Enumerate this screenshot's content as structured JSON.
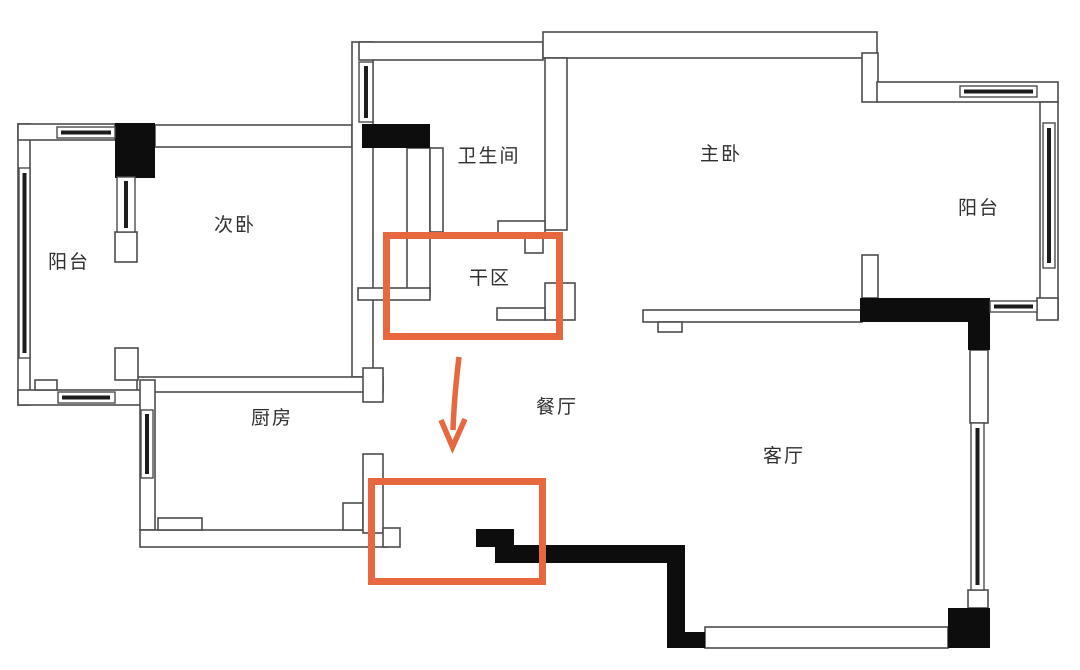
{
  "figure": {
    "type": "floor-plan",
    "description_visible_text_only": true
  },
  "palette": {
    "background": "#ffffff",
    "wall_line": "#4c4c4c",
    "solid_wall": "#0d0d0d",
    "window_core": "#1c1c1c",
    "highlight": "#e7683f",
    "label_color": "#2f2f2f"
  },
  "rooms": [
    {
      "id": "balcony-left",
      "label": "阳台"
    },
    {
      "id": "secondary-bedroom",
      "label": "次卧"
    },
    {
      "id": "bathroom",
      "label": "卫生间"
    },
    {
      "id": "master-bedroom",
      "label": "主卧"
    },
    {
      "id": "balcony-right",
      "label": "阳台"
    },
    {
      "id": "dry-area",
      "label": "干区"
    },
    {
      "id": "kitchen",
      "label": "厨房"
    },
    {
      "id": "dining-room",
      "label": "餐厅"
    },
    {
      "id": "living-room",
      "label": "客厅"
    }
  ],
  "annotations": {
    "highlight_color": "#e7683f",
    "boxes": [
      {
        "id": "dry-area-highlight",
        "around": "干区"
      },
      {
        "id": "relocation-highlight",
        "around": ""
      }
    ],
    "arrow": {
      "direction": "down",
      "from": "dry-area-highlight",
      "to": "relocation-highlight"
    }
  }
}
